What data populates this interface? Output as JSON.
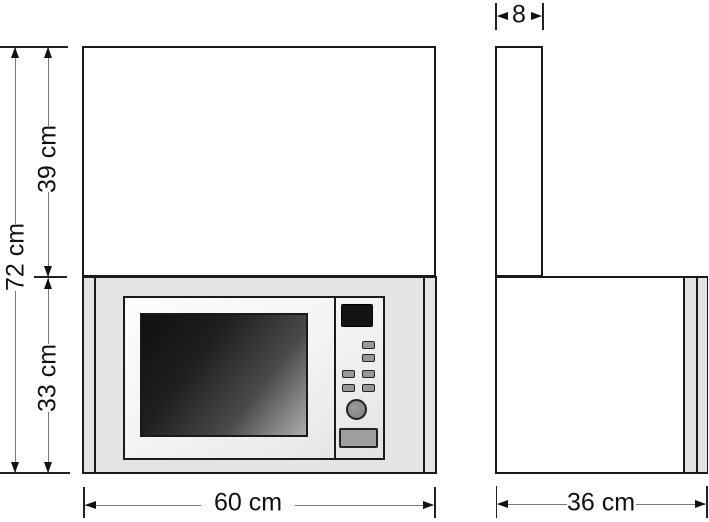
{
  "dimensions": {
    "total_height": "72 cm",
    "upper_section_height": "39 cm",
    "niche_height": "33 cm",
    "front_width": "60 cm",
    "side_top_depth": "8",
    "side_depth": "36 cm"
  },
  "colors": {
    "outline": "#1a1a1a",
    "cabinet_gray": "#e4e4e4",
    "panel_light": "#f9f9f9",
    "window_dark": "#101010",
    "window_light": "#adadad",
    "display_black": "#141414",
    "button_gray": "#989898",
    "knob_gray": "#8a8a8a",
    "dimension_line": "#7a7a7a"
  }
}
